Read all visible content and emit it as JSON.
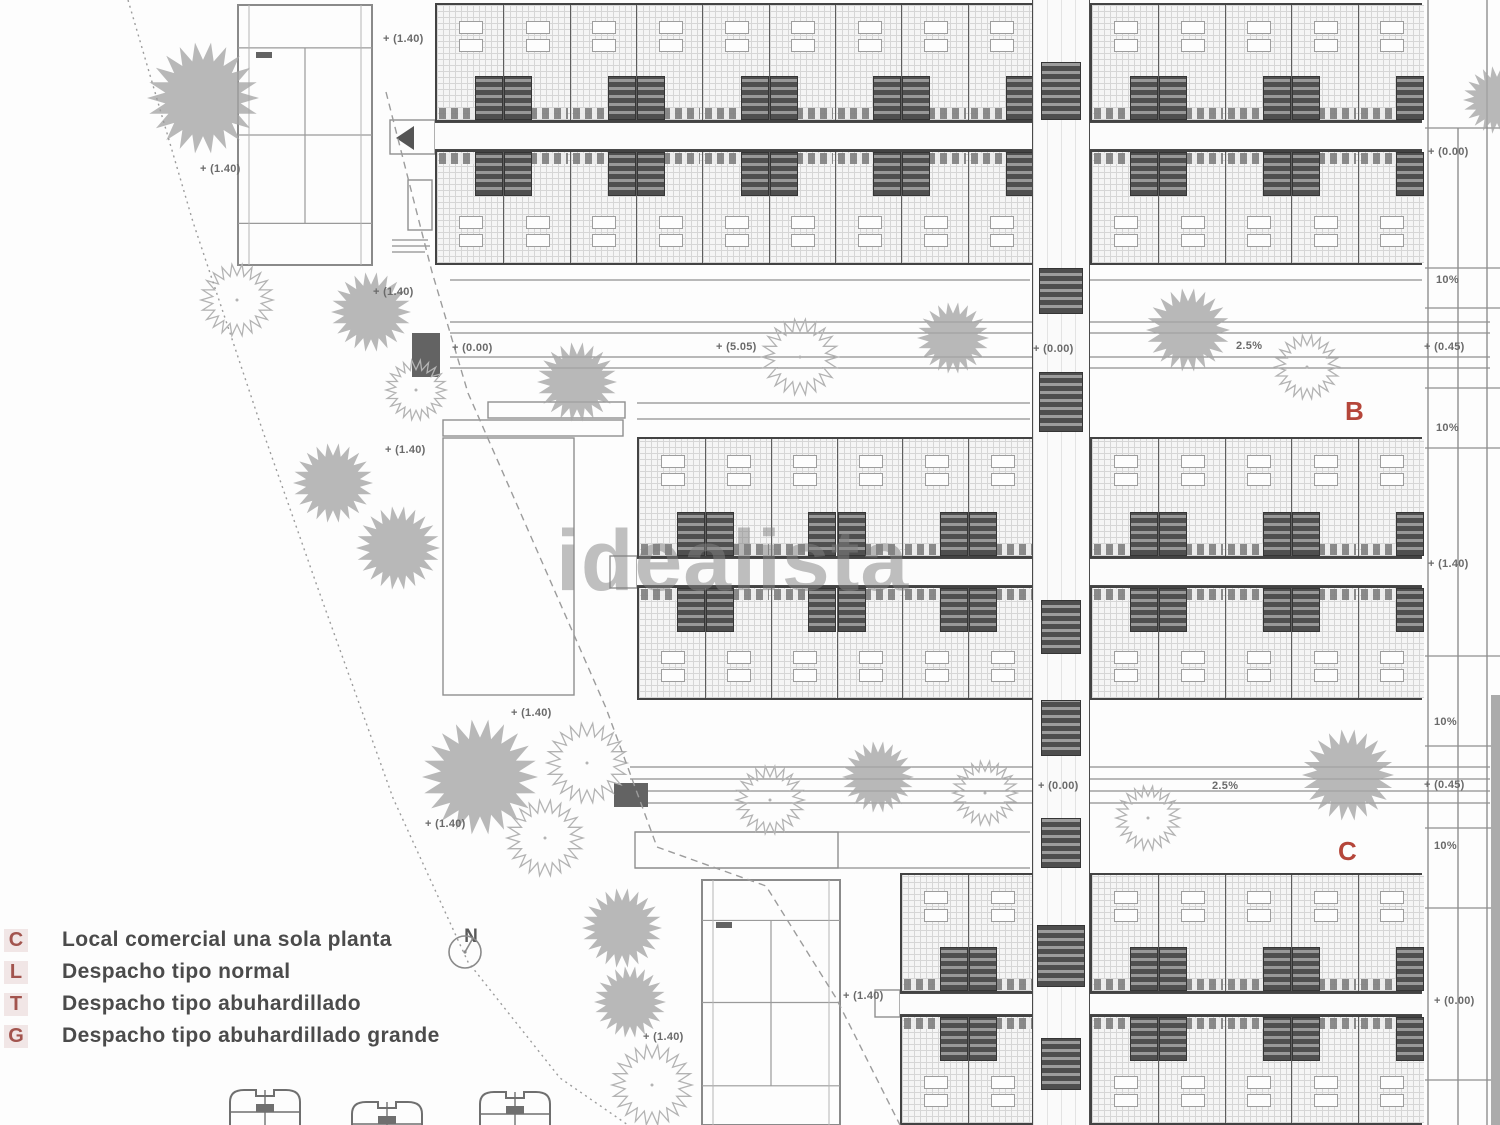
{
  "watermark": {
    "text": "idealista"
  },
  "north": {
    "label": "N"
  },
  "legend": {
    "items": [
      {
        "key": "C",
        "label": "Local comercial una sola planta"
      },
      {
        "key": "L",
        "label": "Despacho tipo normal"
      },
      {
        "key": "T",
        "label": "Despacho tipo abuhardillado"
      },
      {
        "key": "G",
        "label": "Despacho tipo abuhardillado grande"
      }
    ]
  },
  "block_labels": [
    {
      "text": "B",
      "x": 1345,
      "y": 396
    },
    {
      "text": "C",
      "x": 1338,
      "y": 836
    }
  ],
  "annotations": [
    {
      "text": "+ (1.40)",
      "x": 383,
      "y": 33
    },
    {
      "text": "+ (1.40)",
      "x": 200,
      "y": 163
    },
    {
      "text": "+ (1.40)",
      "x": 373,
      "y": 286
    },
    {
      "text": "+ (0.00)",
      "x": 452,
      "y": 342
    },
    {
      "text": "+ (1.40)",
      "x": 385,
      "y": 444
    },
    {
      "text": "+ (5.05)",
      "x": 716,
      "y": 341
    },
    {
      "text": "+ (0.00)",
      "x": 1033,
      "y": 343
    },
    {
      "text": "2.5%",
      "x": 1236,
      "y": 340
    },
    {
      "text": "+ (0.45)",
      "x": 1424,
      "y": 341
    },
    {
      "text": "+ (0.00)",
      "x": 1428,
      "y": 146
    },
    {
      "text": "10%",
      "x": 1436,
      "y": 274
    },
    {
      "text": "10%",
      "x": 1436,
      "y": 422
    },
    {
      "text": "+ (1.40)",
      "x": 1428,
      "y": 558
    },
    {
      "text": "10%",
      "x": 1434,
      "y": 716
    },
    {
      "text": "+ (0.45)",
      "x": 1424,
      "y": 779
    },
    {
      "text": "10%",
      "x": 1434,
      "y": 840
    },
    {
      "text": "+ (1.40)",
      "x": 511,
      "y": 707
    },
    {
      "text": "+ (1.40)",
      "x": 425,
      "y": 818
    },
    {
      "text": "+ (0.00)",
      "x": 1038,
      "y": 780
    },
    {
      "text": "2.5%",
      "x": 1212,
      "y": 780
    },
    {
      "text": "+ (1.40)",
      "x": 843,
      "y": 990
    },
    {
      "text": "+ (1.40)",
      "x": 643,
      "y": 1031
    },
    {
      "text": "+ (0.00)",
      "x": 1434,
      "y": 995
    }
  ],
  "colors": {
    "accent_red": "#b5463a",
    "legend_key_red": "#a2544e",
    "legend_text": "#4b4b4b",
    "annotation_gray": "#6a6a6a",
    "tree_gray": "#a6a6a6",
    "outline_tree_gray": "#b3b3b3",
    "line_dark": "#4a4a4a",
    "watermark_gray": "#828282"
  }
}
